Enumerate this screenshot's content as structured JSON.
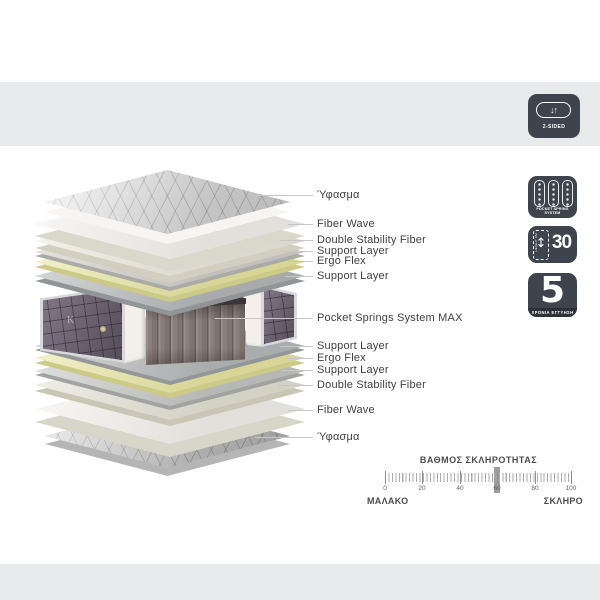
{
  "two_sided_badge": {
    "symbol": "↓↑",
    "label": "2-SIDED"
  },
  "layer_labels": [
    {
      "text": "Ύφασμα"
    },
    {
      "text": "Fiber Wave"
    },
    {
      "text": "Double Stability Fiber"
    },
    {
      "text": "Support Layer"
    },
    {
      "text": "Ergo Flex"
    },
    {
      "text": "Support Layer"
    },
    {
      "text": "Pocket Springs System MAX"
    },
    {
      "text": "Support Layer"
    },
    {
      "text": "Ergo Flex"
    },
    {
      "text": "Support Layer"
    },
    {
      "text": "Double Stability Fiber"
    },
    {
      "text": "Fiber Wave"
    },
    {
      "text": "Ύφασμα"
    }
  ],
  "badges": {
    "pocket_spring": {
      "line1": "POCKET SPRING",
      "line2": "SYSTEM"
    },
    "height": {
      "value": "30",
      "unit_label": "HEIGHT CM",
      "arrow": "↕"
    },
    "warranty": {
      "value": "5",
      "label": "ΧΡΟΝΙΑ ΕΓΓΥΗΣΗ"
    }
  },
  "mattress": {
    "monogram": "K"
  },
  "hardness_scale": {
    "title": "ΒΑΘΜΟΣ ΣΚΛΗΡΟΤΗΤΑΣ",
    "ticks": [
      0,
      20,
      40,
      60,
      80,
      100
    ],
    "marker_value": 60,
    "left_label": "ΜΑΛΑΚΟ",
    "right_label": "ΣΚΛΗΡΟ"
  },
  "colors": {
    "bar_gray": "#e8eaeb",
    "badge_bg": "#3e444d",
    "ergo_flex_yellow": "#eae7a3",
    "panel_purple": "#6e6274",
    "springs_fabric": "#8a7f7c",
    "label_text": "#3f3f3f"
  }
}
